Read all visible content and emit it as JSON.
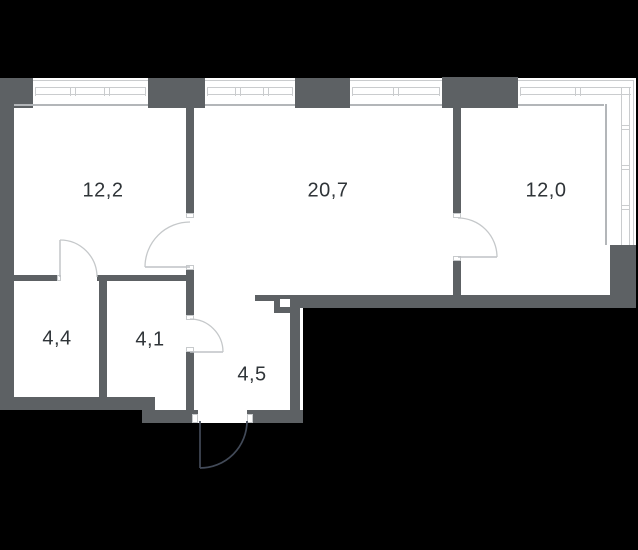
{
  "title": "apartment-floor-plan",
  "rooms": [
    {
      "name": "bedroom-left",
      "area": "12,2"
    },
    {
      "name": "living-room",
      "area": "20,7"
    },
    {
      "name": "bedroom-right",
      "area": "12,0"
    },
    {
      "name": "bathroom",
      "area": "4,4"
    },
    {
      "name": "wc",
      "area": "4,1"
    },
    {
      "name": "hallway",
      "area": "4,5"
    }
  ],
  "colors": {
    "background": "#000000",
    "wall": "#5d6164",
    "room_fill": "#ffffff",
    "window_line": "#caccce",
    "inner_edge_line": "#b3b6b9",
    "door_swing": "#c5c8ca",
    "entrance_swing": "#424a58",
    "label_text": "#2f3438"
  }
}
